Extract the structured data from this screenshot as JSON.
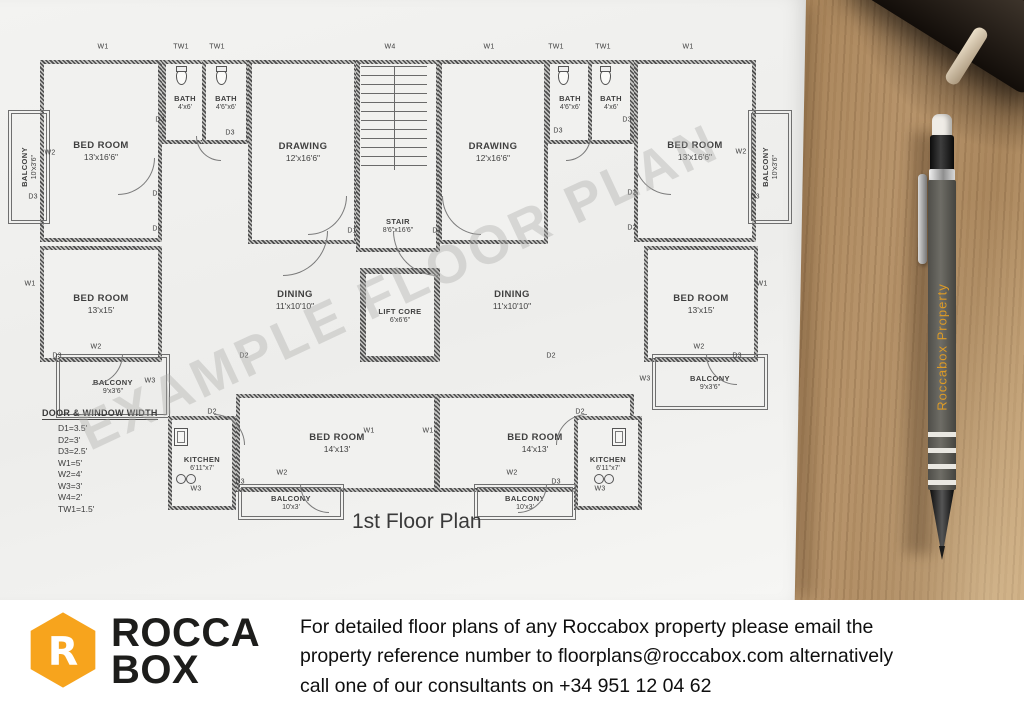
{
  "floor_plan": {
    "title": "1st Floor Plan",
    "watermark": "EXAMPLE FLOOR PLAN",
    "legend": {
      "title": "DOOR & WINDOW WIDTH",
      "items": [
        "D1=3.5'",
        "D2=3'",
        "D3=2.5'",
        "W1=5'",
        "W2=4'",
        "W3=3'",
        "W4=2'",
        "TW1=1.5'"
      ]
    },
    "rooms": [
      {
        "id": "bedroom-top-left",
        "name": "BED ROOM",
        "size": "13'x16'6\"",
        "x": 40,
        "y": 60,
        "w": 114,
        "h": 174,
        "style": ""
      },
      {
        "id": "bath-left-a",
        "name": "BATH",
        "size": "4'x6'",
        "x": 162,
        "y": 60,
        "w": 38,
        "h": 76,
        "style": "small"
      },
      {
        "id": "bath-left-b",
        "name": "BATH",
        "size": "4'6\"x6'",
        "x": 202,
        "y": 60,
        "w": 40,
        "h": 76,
        "style": "small"
      },
      {
        "id": "drawing-left",
        "name": "DRAWING",
        "size": "12'x16'6\"",
        "x": 248,
        "y": 60,
        "w": 102,
        "h": 176,
        "style": ""
      },
      {
        "id": "stair",
        "name": "STAIR",
        "size": "8'6\"x16'6\"",
        "x": 356,
        "y": 60,
        "w": 76,
        "h": 170,
        "style": "small label-bottom"
      },
      {
        "id": "drawing-right",
        "name": "DRAWING",
        "size": "12'x16'6\"",
        "x": 438,
        "y": 60,
        "w": 102,
        "h": 176,
        "style": ""
      },
      {
        "id": "bath-right-a",
        "name": "BATH",
        "size": "4'6\"x6'",
        "x": 546,
        "y": 60,
        "w": 40,
        "h": 76,
        "style": "small"
      },
      {
        "id": "bath-right-b",
        "name": "BATH",
        "size": "4'x6'",
        "x": 588,
        "y": 60,
        "w": 38,
        "h": 76,
        "style": "small"
      },
      {
        "id": "bedroom-top-right",
        "name": "BED ROOM",
        "size": "13'x16'6\"",
        "x": 634,
        "y": 60,
        "w": 114,
        "h": 174,
        "style": ""
      },
      {
        "id": "balcony-top-left",
        "name": "BALCONY",
        "size": "10'x3'6\"",
        "x": 8,
        "y": 110,
        "w": 34,
        "h": 106,
        "style": "balcony small vertical"
      },
      {
        "id": "balcony-top-right",
        "name": "BALCONY",
        "size": "10'x3'6\"",
        "x": 748,
        "y": 110,
        "w": 36,
        "h": 106,
        "style": "balcony small vertical"
      },
      {
        "id": "bedroom-mid-left",
        "name": "BED ROOM",
        "size": "13'x15'",
        "x": 40,
        "y": 246,
        "w": 114,
        "h": 108,
        "style": ""
      },
      {
        "id": "dining-left",
        "name": "DINING",
        "size": "11'x10'10\"",
        "x": 236,
        "y": 252,
        "w": 118,
        "h": 96,
        "style": "open"
      },
      {
        "id": "lift-core",
        "name": "LIFT CORE",
        "size": "6'x6'6\"",
        "x": 360,
        "y": 268,
        "w": 68,
        "h": 82,
        "style": "small heavy"
      },
      {
        "id": "dining-right",
        "name": "DINING",
        "size": "11'x10'10\"",
        "x": 452,
        "y": 252,
        "w": 120,
        "h": 96,
        "style": "open"
      },
      {
        "id": "bedroom-mid-right",
        "name": "BED ROOM",
        "size": "13'x15'",
        "x": 644,
        "y": 246,
        "w": 106,
        "h": 108,
        "style": ""
      },
      {
        "id": "balcony-mid-left",
        "name": "BALCONY",
        "size": "9'x3'6\"",
        "x": 56,
        "y": 354,
        "w": 106,
        "h": 56,
        "style": "balcony small"
      },
      {
        "id": "balcony-mid-right",
        "name": "BALCONY",
        "size": "9'x3'6\"",
        "x": 652,
        "y": 354,
        "w": 108,
        "h": 48,
        "style": "balcony small"
      },
      {
        "id": "kitchen-left",
        "name": "KITCHEN",
        "size": "6'11\"x7'",
        "x": 168,
        "y": 416,
        "w": 60,
        "h": 86,
        "style": "small"
      },
      {
        "id": "bedroom-bottom-left",
        "name": "BED ROOM",
        "size": "14'x13'",
        "x": 236,
        "y": 394,
        "w": 194,
        "h": 90,
        "style": ""
      },
      {
        "id": "bedroom-bottom-right",
        "name": "BED ROOM",
        "size": "14'x13'",
        "x": 436,
        "y": 394,
        "w": 190,
        "h": 90,
        "style": ""
      },
      {
        "id": "kitchen-right",
        "name": "KITCHEN",
        "size": "6'11\"x7'",
        "x": 574,
        "y": 416,
        "w": 60,
        "h": 86,
        "style": "small"
      },
      {
        "id": "balcony-bottom-left",
        "name": "BALCONY",
        "size": "10'x3'",
        "x": 238,
        "y": 484,
        "w": 98,
        "h": 28,
        "style": "balcony small"
      },
      {
        "id": "balcony-bottom-right",
        "name": "BALCONY",
        "size": "10'x3'",
        "x": 474,
        "y": 484,
        "w": 94,
        "h": 28,
        "style": "balcony small"
      }
    ],
    "markers": [
      {
        "label": "W1",
        "x": 103,
        "y": 47
      },
      {
        "label": "TW1",
        "x": 181,
        "y": 47
      },
      {
        "label": "TW1",
        "x": 217,
        "y": 47
      },
      {
        "label": "W4",
        "x": 390,
        "y": 47
      },
      {
        "label": "W1",
        "x": 489,
        "y": 47
      },
      {
        "label": "TW1",
        "x": 556,
        "y": 47
      },
      {
        "label": "TW1",
        "x": 603,
        "y": 47
      },
      {
        "label": "W1",
        "x": 688,
        "y": 47
      },
      {
        "label": "W2",
        "x": 50,
        "y": 153
      },
      {
        "label": "D3",
        "x": 33,
        "y": 197
      },
      {
        "label": "W1",
        "x": 30,
        "y": 284
      },
      {
        "label": "W2",
        "x": 96,
        "y": 347
      },
      {
        "label": "D3",
        "x": 57,
        "y": 356
      },
      {
        "label": "W3",
        "x": 150,
        "y": 381
      },
      {
        "label": "W2",
        "x": 741,
        "y": 152
      },
      {
        "label": "D3",
        "x": 755,
        "y": 197
      },
      {
        "label": "W1",
        "x": 762,
        "y": 284
      },
      {
        "label": "W2",
        "x": 699,
        "y": 347
      },
      {
        "label": "D3",
        "x": 737,
        "y": 356
      },
      {
        "label": "W3",
        "x": 645,
        "y": 379
      },
      {
        "label": "D3",
        "x": 160,
        "y": 120
      },
      {
        "label": "D3",
        "x": 230,
        "y": 133
      },
      {
        "label": "D2",
        "x": 157,
        "y": 194
      },
      {
        "label": "D2",
        "x": 157,
        "y": 229
      },
      {
        "label": "D1",
        "x": 352,
        "y": 231
      },
      {
        "label": "D1",
        "x": 437,
        "y": 231
      },
      {
        "label": "D3",
        "x": 558,
        "y": 131
      },
      {
        "label": "D3",
        "x": 627,
        "y": 120
      },
      {
        "label": "D2",
        "x": 632,
        "y": 193
      },
      {
        "label": "D2",
        "x": 632,
        "y": 228
      },
      {
        "label": "D2",
        "x": 244,
        "y": 356
      },
      {
        "label": "D2",
        "x": 551,
        "y": 356
      },
      {
        "label": "D2",
        "x": 212,
        "y": 412
      },
      {
        "label": "W3",
        "x": 196,
        "y": 489
      },
      {
        "label": "D3",
        "x": 240,
        "y": 482
      },
      {
        "label": "W2",
        "x": 282,
        "y": 473
      },
      {
        "label": "W1",
        "x": 369,
        "y": 431
      },
      {
        "label": "W1",
        "x": 428,
        "y": 431
      },
      {
        "label": "W2",
        "x": 512,
        "y": 473
      },
      {
        "label": "D3",
        "x": 556,
        "y": 482
      },
      {
        "label": "W3",
        "x": 600,
        "y": 489
      },
      {
        "label": "D2",
        "x": 580,
        "y": 412
      }
    ],
    "arcs": [
      {
        "x": 283,
        "y": 231,
        "r": 44,
        "c": "br"
      },
      {
        "x": 393,
        "y": 231,
        "r": 44,
        "c": "bl"
      },
      {
        "x": 118,
        "y": 158,
        "r": 36,
        "c": "br"
      },
      {
        "x": 634,
        "y": 158,
        "r": 36,
        "c": "bl"
      },
      {
        "x": 308,
        "y": 196,
        "r": 38,
        "c": "br"
      },
      {
        "x": 442,
        "y": 196,
        "r": 38,
        "c": "bl"
      },
      {
        "x": 196,
        "y": 136,
        "r": 24,
        "c": "bl"
      },
      {
        "x": 566,
        "y": 136,
        "r": 24,
        "c": "br"
      },
      {
        "x": 92,
        "y": 354,
        "r": 30,
        "c": "br"
      },
      {
        "x": 706,
        "y": 354,
        "r": 30,
        "c": "bl"
      },
      {
        "x": 300,
        "y": 484,
        "r": 28,
        "c": "bl"
      },
      {
        "x": 518,
        "y": 484,
        "r": 28,
        "c": "br"
      },
      {
        "x": 214,
        "y": 414,
        "r": 30,
        "c": "tr"
      },
      {
        "x": 556,
        "y": 414,
        "r": 30,
        "c": "tl"
      }
    ],
    "fixtures": [
      {
        "type": "wc",
        "x": 176,
        "y": 70
      },
      {
        "type": "wc",
        "x": 216,
        "y": 70
      },
      {
        "type": "wc",
        "x": 558,
        "y": 70
      },
      {
        "type": "wc",
        "x": 600,
        "y": 70
      },
      {
        "type": "sink",
        "x": 174,
        "y": 428
      },
      {
        "type": "sink",
        "x": 612,
        "y": 428
      },
      {
        "type": "burners",
        "x": 176,
        "y": 474
      },
      {
        "type": "burners",
        "x": 594,
        "y": 474
      }
    ]
  },
  "pencil": {
    "brand_text": "Roccabox Property"
  },
  "footer": {
    "logo_line1": "ROCCA",
    "logo_line2": "BOX",
    "lines": [
      "For detailed floor plans of any Roccabox property please email the",
      "property reference number to floorplans@roccabox.com alternatively",
      "call one of our consultants on +34 951 12 04 62"
    ]
  },
  "colors": {
    "logo_orange": "#F7A41D",
    "logo_text": "#1D1D1B",
    "pencil_brand_orange": "#DC9A26",
    "paper": "#F1F1EF",
    "plan_line": "#4E4E4E",
    "wood": "#B08A5E"
  }
}
